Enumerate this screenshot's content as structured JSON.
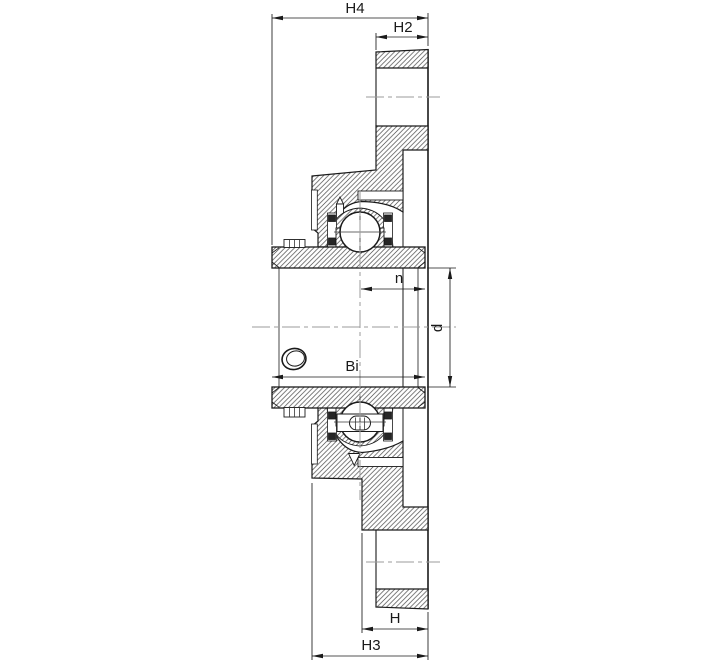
{
  "drawing": {
    "labels": {
      "h4": "H4",
      "h2": "H2",
      "n": "n",
      "d": "d",
      "bi": "Bi",
      "h": "H",
      "h3": "H3"
    },
    "colors": {
      "line": "#1a1a1a",
      "hatch": "#4d4d4d",
      "centerline": "#9b9b9b",
      "seal": "#262626",
      "background": "#ffffff"
    }
  }
}
